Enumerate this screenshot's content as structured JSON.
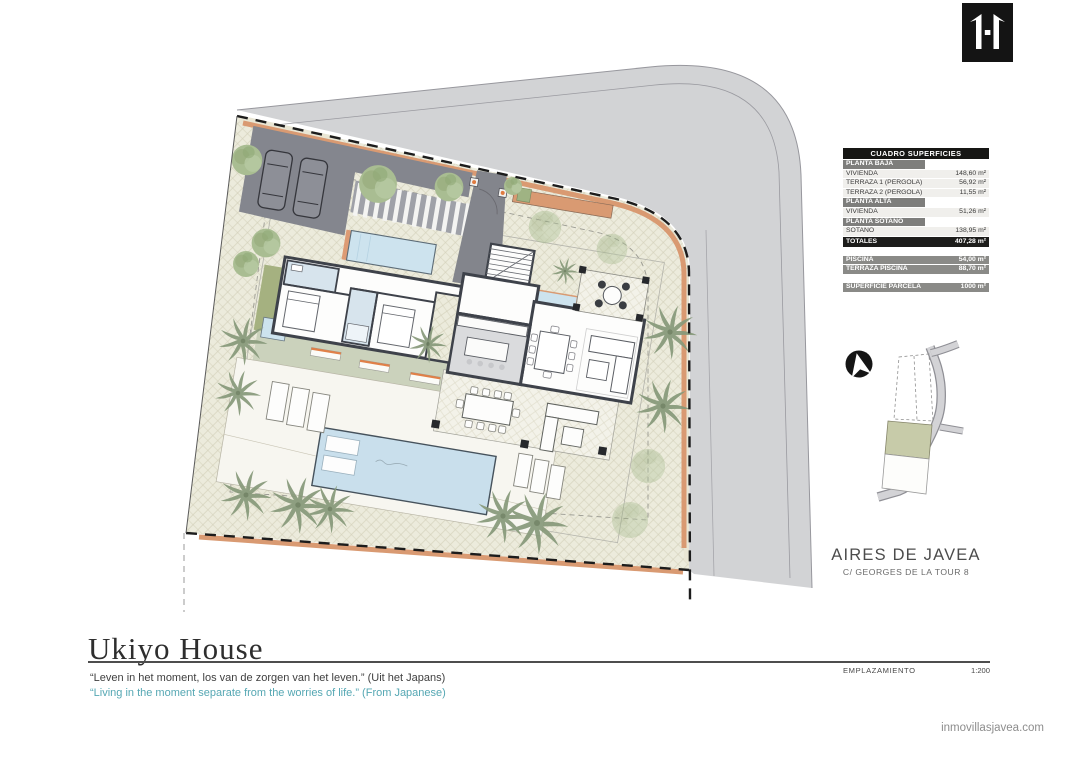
{
  "logo": {
    "name": "inmovillas-javea-logo"
  },
  "surface_table": {
    "title": "CUADRO SUPERFICIES",
    "rows": [
      {
        "type": "section",
        "label": "PLANTA BAJA",
        "value": ""
      },
      {
        "type": "row",
        "label": "VIVIENDA",
        "value": "148,60 m²"
      },
      {
        "type": "row",
        "label": "TERRAZA 1 (PERGOLA)",
        "value": "56,92 m²"
      },
      {
        "type": "row",
        "label": "TERRAZA 2 (PERGOLA)",
        "value": "11,55 m²"
      },
      {
        "type": "section",
        "label": "PLANTA ALTA",
        "value": ""
      },
      {
        "type": "row",
        "label": "VIVIENDA",
        "value": "51,26 m²"
      },
      {
        "type": "section",
        "label": "PLANTA SÓTANO",
        "value": ""
      },
      {
        "type": "row",
        "label": "SOTANO",
        "value": "138,95 m²"
      },
      {
        "type": "total",
        "label": "TOTALES",
        "value": "407,28 m²"
      }
    ],
    "pool_rows": [
      {
        "type": "gray",
        "label": "PISCINA",
        "value": "54,00 m²"
      },
      {
        "type": "gray",
        "label": "TERRAZA PISCINA",
        "value": "88,70 m²"
      }
    ],
    "parcel_rows": [
      {
        "type": "gray",
        "label": "SUPERFICIE PARCELA",
        "value": "1000 m²"
      }
    ]
  },
  "location": {
    "name": "AIRES DE JAVEA",
    "address": "C/ GEORGES DE LA TOUR 8"
  },
  "titleblock": {
    "title": "Ukiyo House",
    "quote_nl": "“Leven in het moment, los van de zorgen van het leven.” (Uit het Japans)",
    "quote_en": "“Living in the moment separate from the worries of life.” (From Japanese)",
    "plan_label": "EMPLAZAMIENTO",
    "scale": "1:200"
  },
  "footer": {
    "website": "inmovillasjavea.com"
  },
  "icons": {
    "north_arrow": "north-arrow-icon",
    "logo": "brand-logo"
  },
  "colors": {
    "accent_orange": "#d99a72",
    "pool_blue": "#c9dfec",
    "road_gray": "#d2d3d5",
    "parcel_beige": "#ecebdc",
    "grass_green": "#a5b180",
    "sage": "#cbd2bc",
    "quote_teal": "#55a7b3",
    "wall_dark": "#3e424a"
  }
}
